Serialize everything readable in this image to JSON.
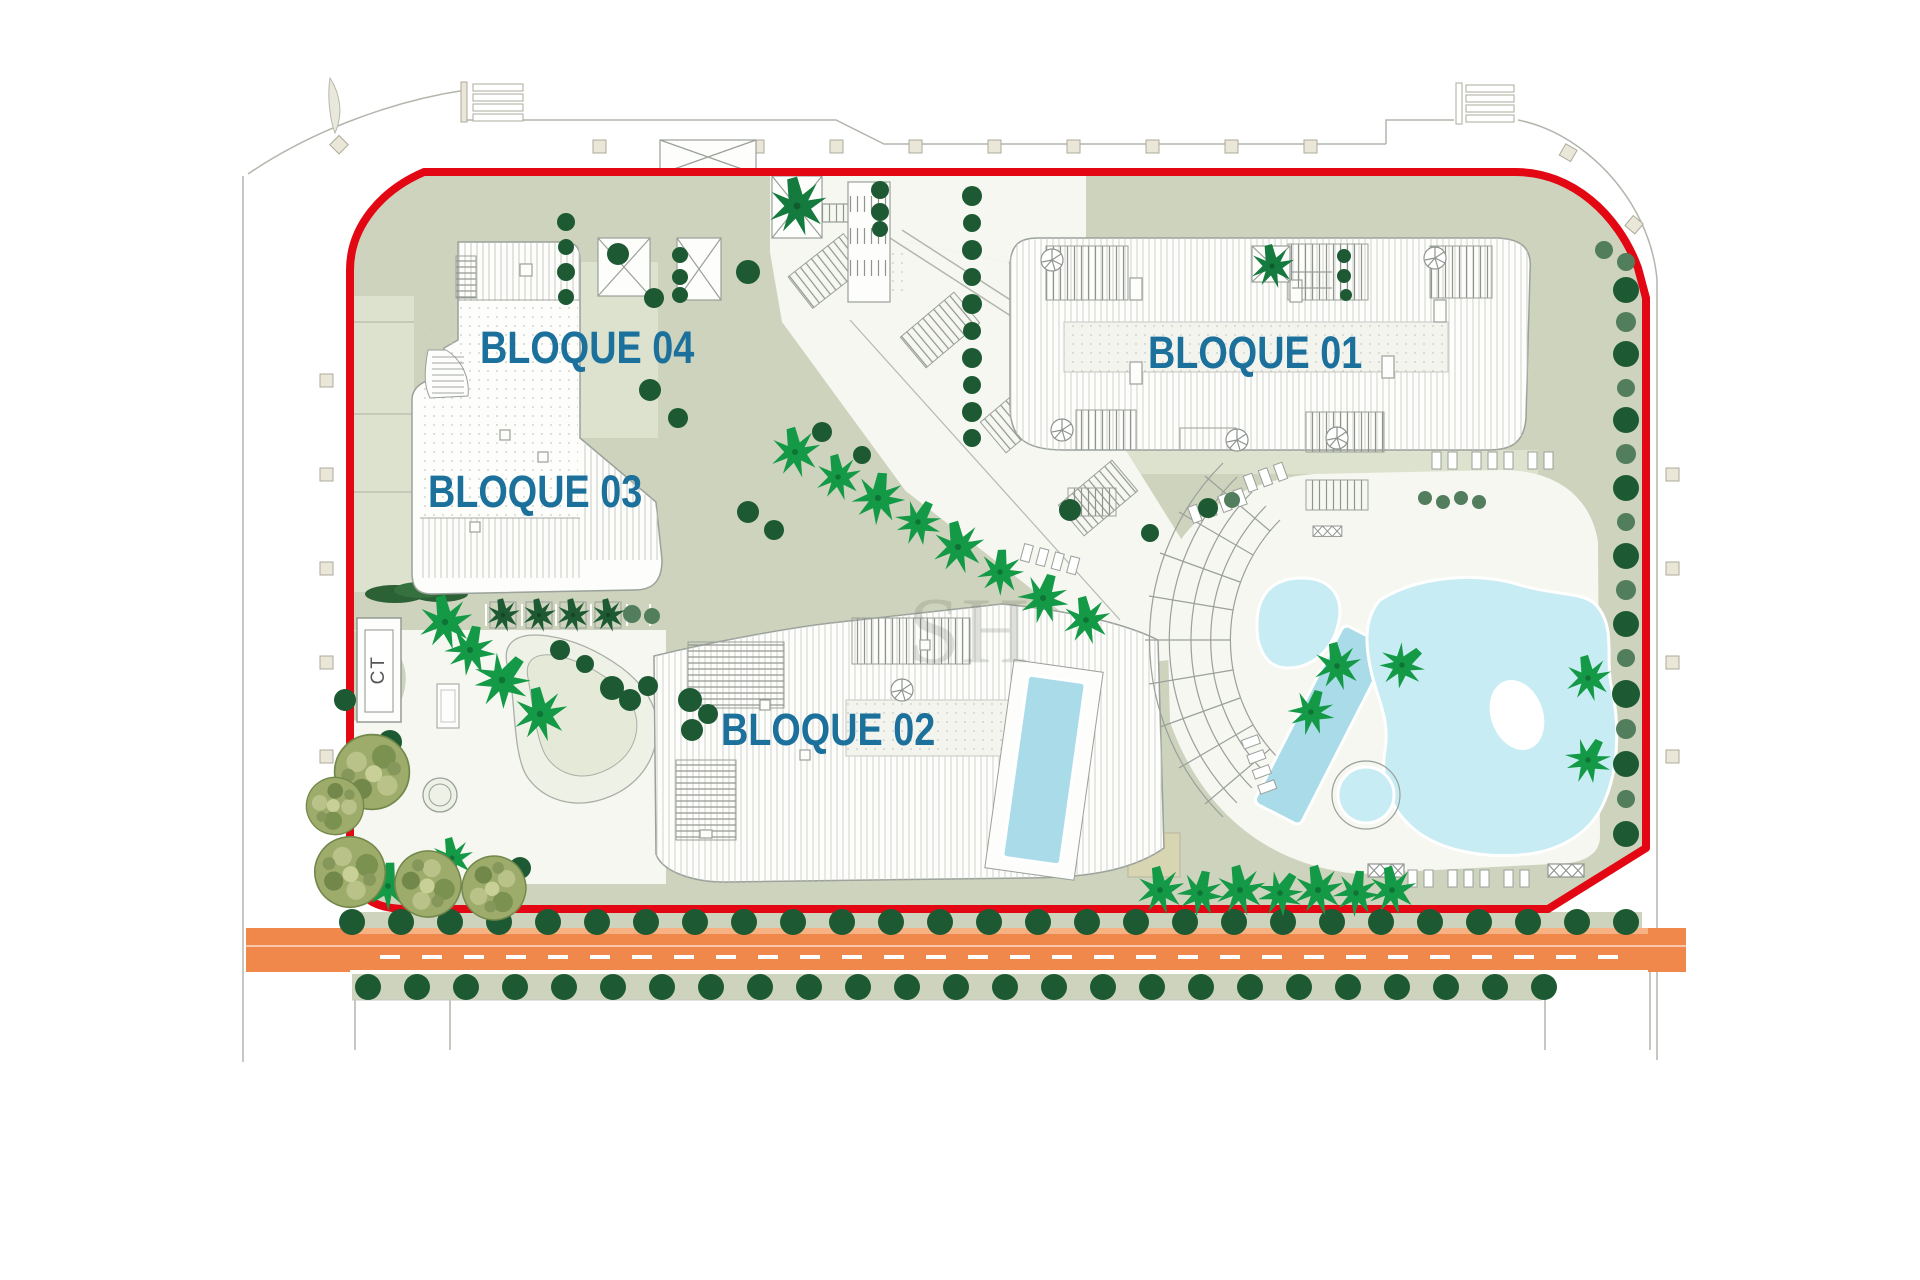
{
  "plan": {
    "blocks": [
      {
        "id": "bloque-01",
        "label": "BLOQUE 01"
      },
      {
        "id": "bloque-02",
        "label": "BLOQUE 02"
      },
      {
        "id": "bloque-03",
        "label": "BLOQUE 03"
      },
      {
        "id": "bloque-04",
        "label": "BLOQUE 04"
      }
    ],
    "transformer_label": "CT",
    "watermark": "SH",
    "colors": {
      "boundary_red": "#E30613",
      "road_orange": "#F1884B",
      "road_orange_light": "#F6B283",
      "label_blue": "#1B719C",
      "sage_green": "#CDD3BC",
      "sage_light": "#DDE2CE",
      "pool_blue": "#C7ECF3",
      "pool_lap_blue": "#A9DBE8",
      "tree_dark": "#1D5A33",
      "tree_medium": "#527E5E",
      "palm_green": "#149A47",
      "plaza_white": "#F6F7F1",
      "building_white": "#FDFDFB"
    }
  }
}
